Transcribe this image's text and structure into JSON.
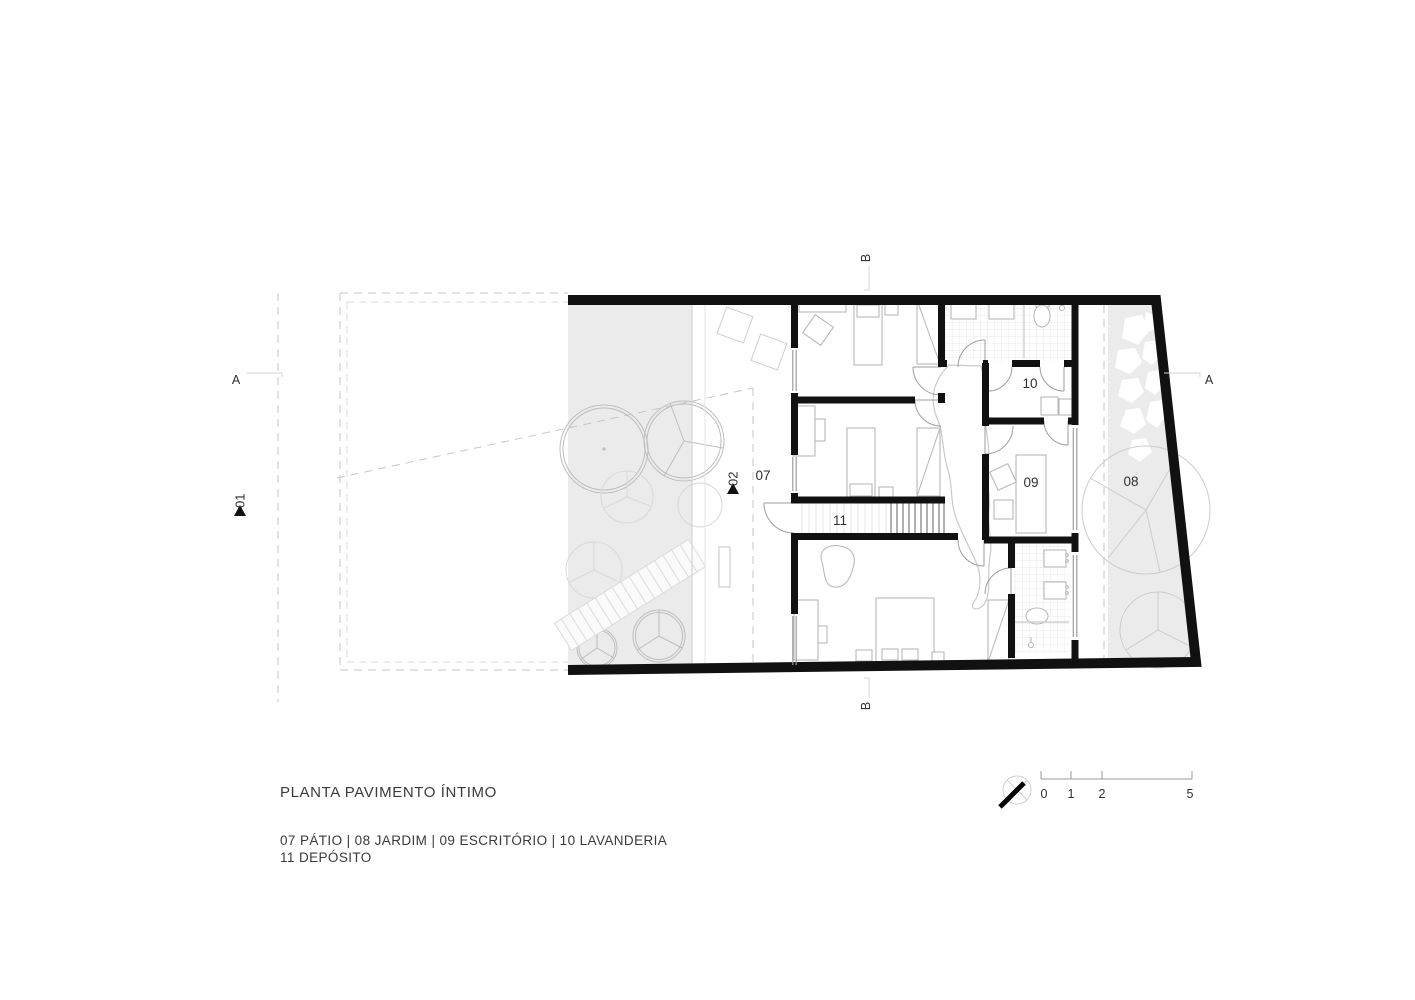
{
  "title": "PLANTA PAVIMENTO ÍNTIMO",
  "legend": {
    "line1": "07 PÁTIO  |  08 JARDIM  |  09 ESCRITÓRIO  |  10 LAVANDERIA",
    "line2": "11 DEPÓSITO",
    "items": [
      {
        "number": "07",
        "name": "PÁTIO"
      },
      {
        "number": "08",
        "name": "JARDIM"
      },
      {
        "number": "09",
        "name": "ESCRITÓRIO"
      },
      {
        "number": "10",
        "name": "LAVANDERIA"
      },
      {
        "number": "11",
        "name": "DEPÓSITO"
      }
    ]
  },
  "room_labels": {
    "patio": "07",
    "jardim": "08",
    "escritorio": "09",
    "lavanderia": "10",
    "deposito": "11"
  },
  "markers": {
    "section_a_left": "A",
    "section_a_right": "A",
    "section_b_top": "B",
    "section_b_bottom": "B",
    "level_01": "01",
    "level_02": "02"
  },
  "scale_bar": {
    "ticks": [
      "0",
      "1",
      "2",
      "5"
    ]
  },
  "colors": {
    "wall": "#111111",
    "ground_fill": "#ebebeb",
    "furniture_line": "#b9b9b9",
    "dashed_line": "#c6c6c6",
    "text": "#2f2f2f"
  }
}
